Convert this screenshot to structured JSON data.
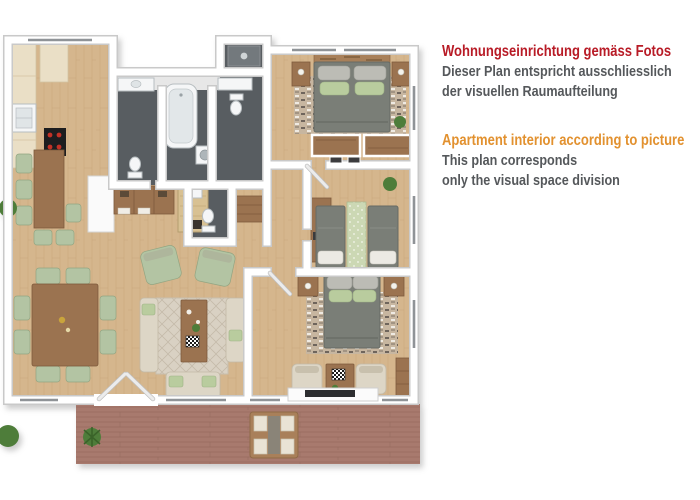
{
  "annotation": {
    "german": {
      "heading": "Wohnungseinrichtung gemäss Fotos",
      "body_line1": "Dieser Plan entspricht ausschliesslich",
      "body_line2": "der visuellen Raumaufteilung"
    },
    "english": {
      "heading": "Apartment interior according to picture",
      "body_line1": "This plan corresponds",
      "body_line2": "only the visual space division"
    }
  },
  "colors": {
    "german_heading": "#b81b26",
    "english_heading": "#e2912f",
    "body_text": "#55585b",
    "background": "#ffffff",
    "wood_floor": "#d5b68d",
    "wood_floor_dark": "#bb9a6e",
    "terrace_deck": "#a87a6e",
    "terrace_deck_dark": "#8f6557",
    "bathroom_tile": "#585d61",
    "bathroom_tile_light": "#73797d",
    "wall_fill": "#ffffff",
    "wall_edge": "#c9c9c9",
    "cabinet_cream": "#eadfc6",
    "furniture_brown": "#9b7350",
    "furniture_brown_dark": "#7e5a3c",
    "bed_gray": "#7a7e77",
    "bed_gray_dark": "#676b64",
    "pillow_green": "#b9cc9e",
    "pillow_gray": "#bcbcb5",
    "sofa_beige": "#ddd6c6",
    "chair_green": "#b3c4a3",
    "rug_base": "#c7b6a0",
    "plant_green": "#4e7d3a",
    "fixture_white": "#f5f6f7",
    "cooktop_black": "#1d1d1f",
    "burner_red": "#c33126"
  }
}
